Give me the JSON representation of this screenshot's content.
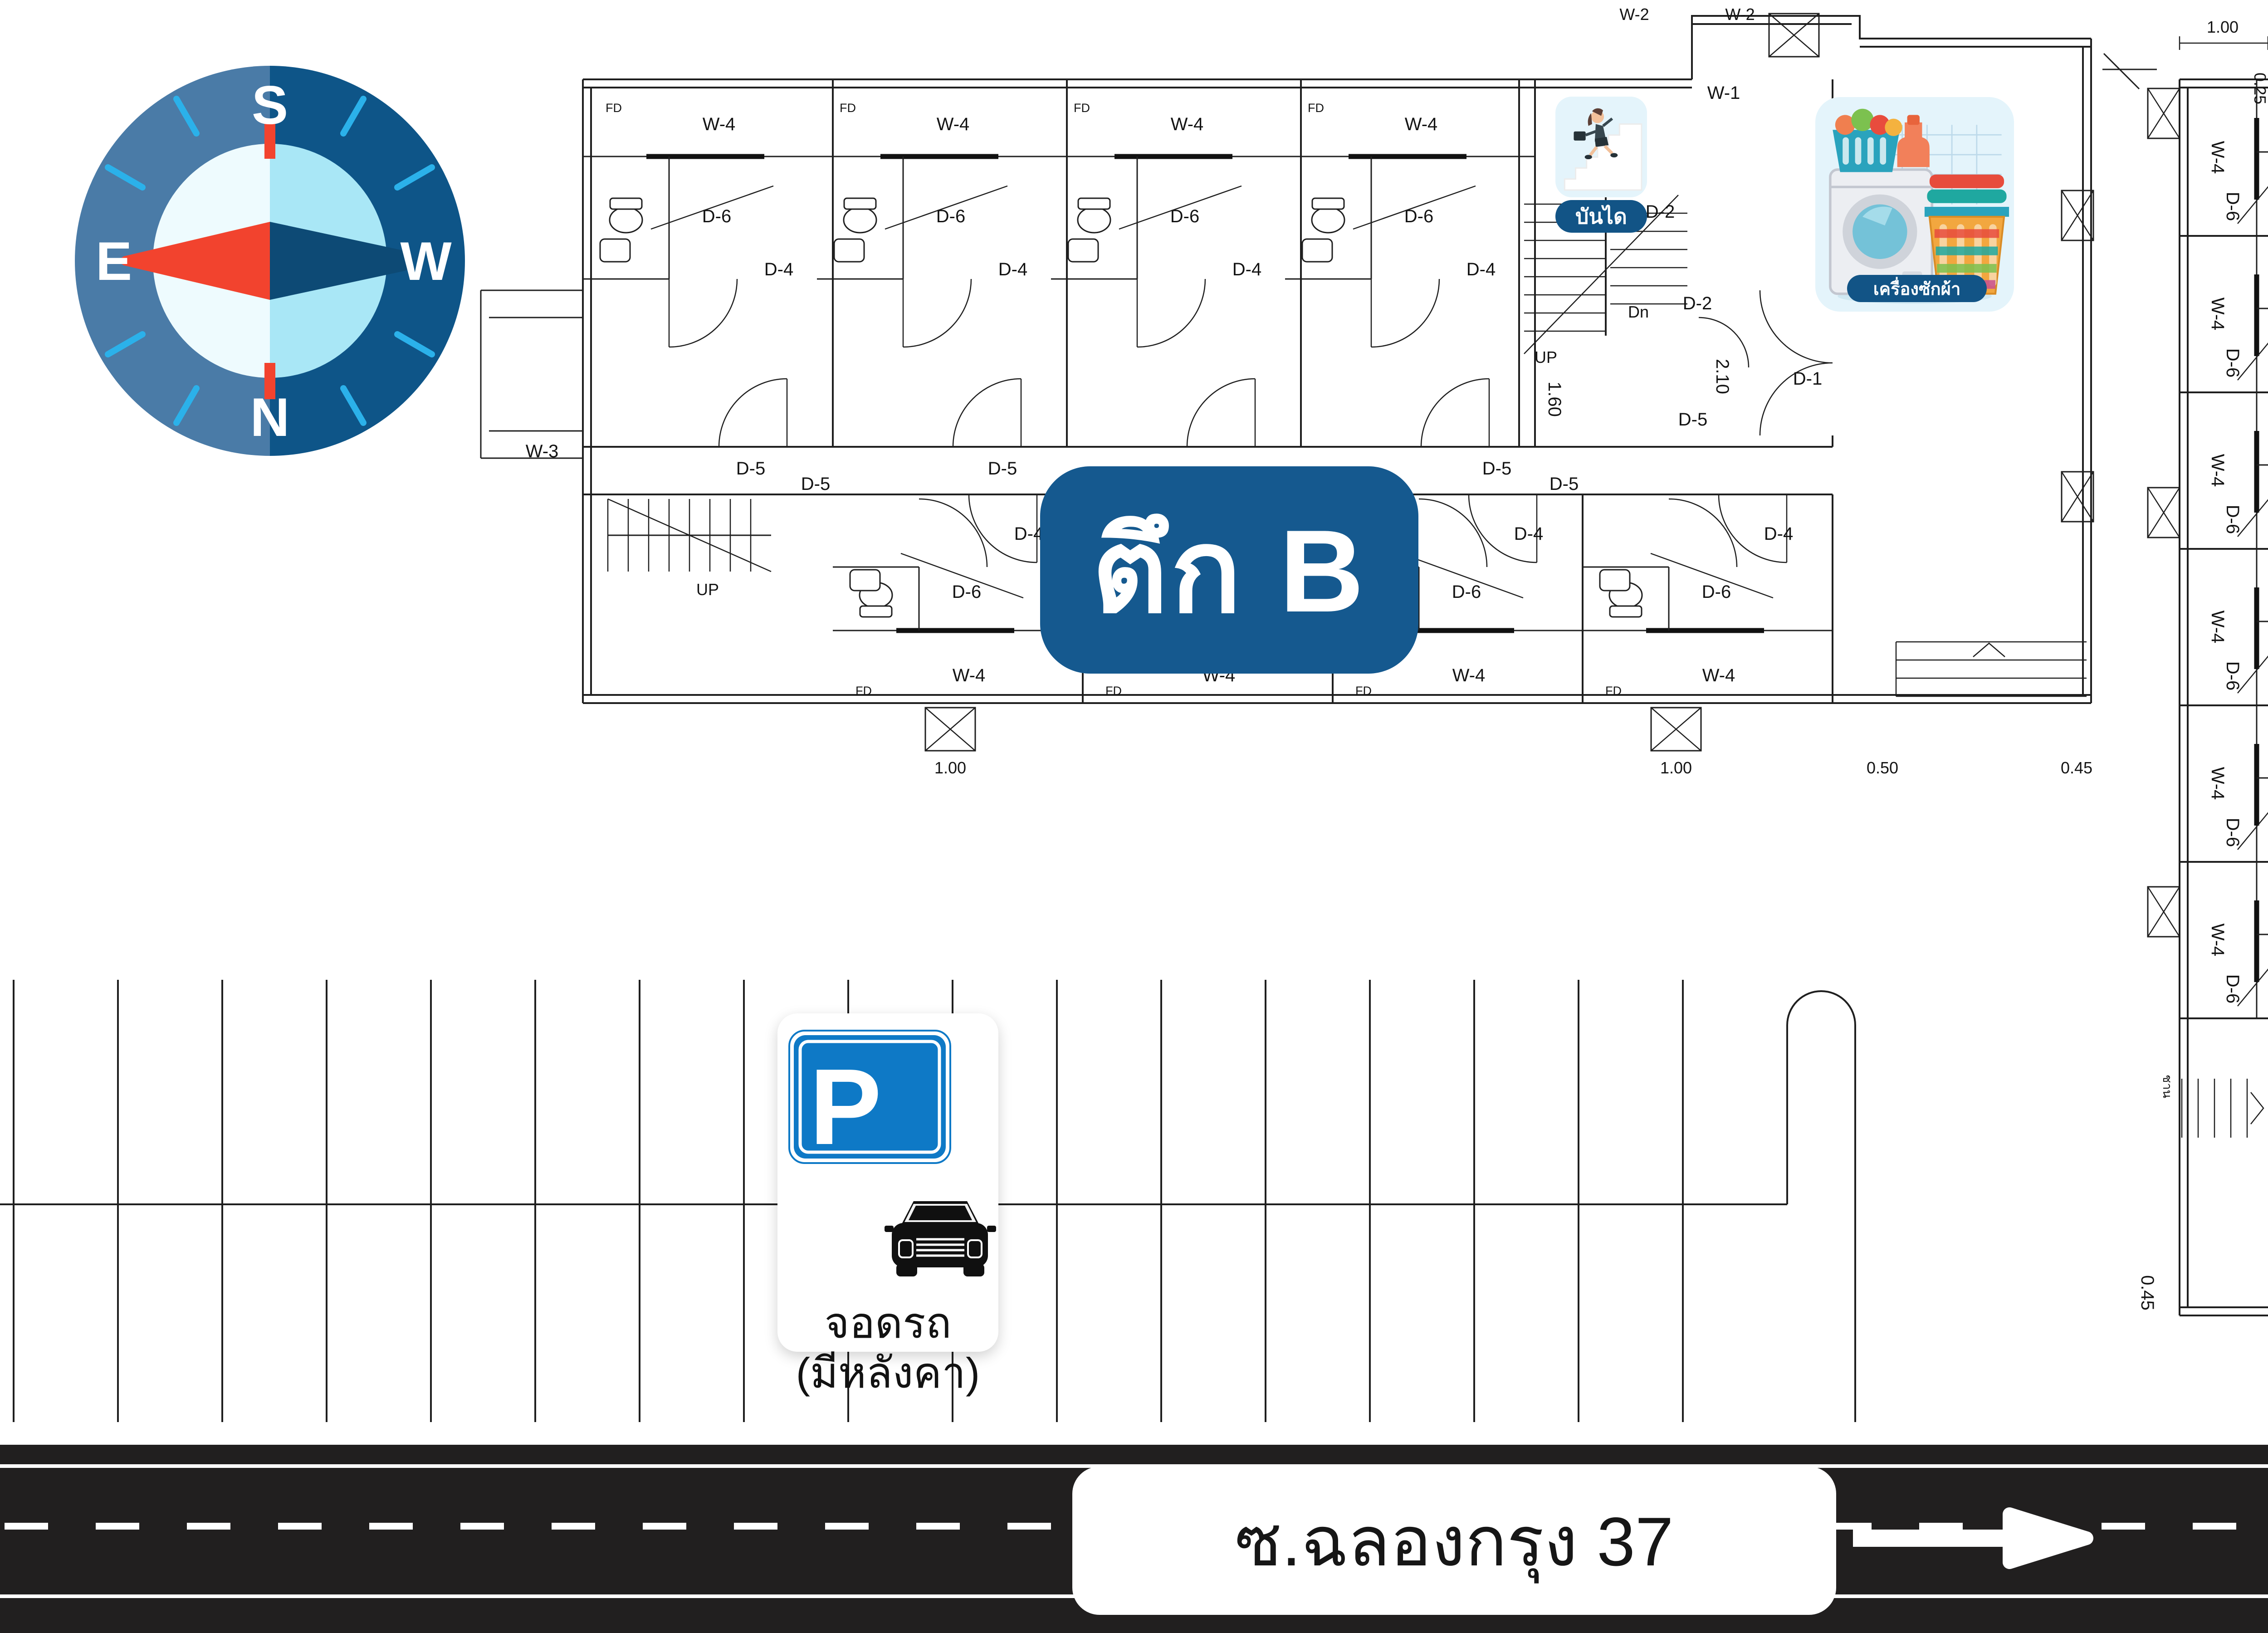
{
  "compass": {
    "north": "N",
    "south": "S",
    "east": "E",
    "west": "W"
  },
  "badges": {
    "building_b": "ตึก B",
    "building_a": "ตึก A"
  },
  "amenities": {
    "stairs": "บันได",
    "laundry": "เครื่องซักผ้า",
    "shop": "ร้านขายของ"
  },
  "shop_art": {
    "flower_sign": "FLOWER",
    "open_sign": "Open"
  },
  "parking": {
    "p": "P",
    "line1": "จอดรถ",
    "line2": "(มีหลังคา)"
  },
  "road": {
    "name": "ซ.ฉลองกรุง 37"
  },
  "codes": {
    "w1": "W-1",
    "w2": "W-2",
    "w3": "W-3",
    "w4": "W-4",
    "w6": "W-6",
    "d1": "D-1",
    "d2": "D-2",
    "d3": "D-3",
    "d4": "D-4",
    "d5": "D-5",
    "d6": "D-6",
    "fd": "FD",
    "up": "UP",
    "dn": "Dn",
    "chan": "ชาน"
  },
  "dims": {
    "d025": "0.25",
    "d045": "0.45",
    "d050": "0.50",
    "d100": "1.00",
    "d160": "1.60",
    "d180": "1.80",
    "d210": "2.10",
    "d240": "2.40"
  },
  "colors": {
    "badge_blue": "#15598f",
    "pill_blue": "#125486",
    "card_blue": "#e4f4fb",
    "road_black": "#211f1f",
    "needle_red": "#f2432e",
    "needle_navy": "#0d4a75",
    "compass_outer_left": "#4a7ba7",
    "compass_outer_right": "#0e5588",
    "compass_inner_left": "#eefbfe",
    "compass_inner_right": "#a9e7f6",
    "tick_cyan": "#2bb1ea",
    "p_sign_blue": "#0e79c6"
  }
}
